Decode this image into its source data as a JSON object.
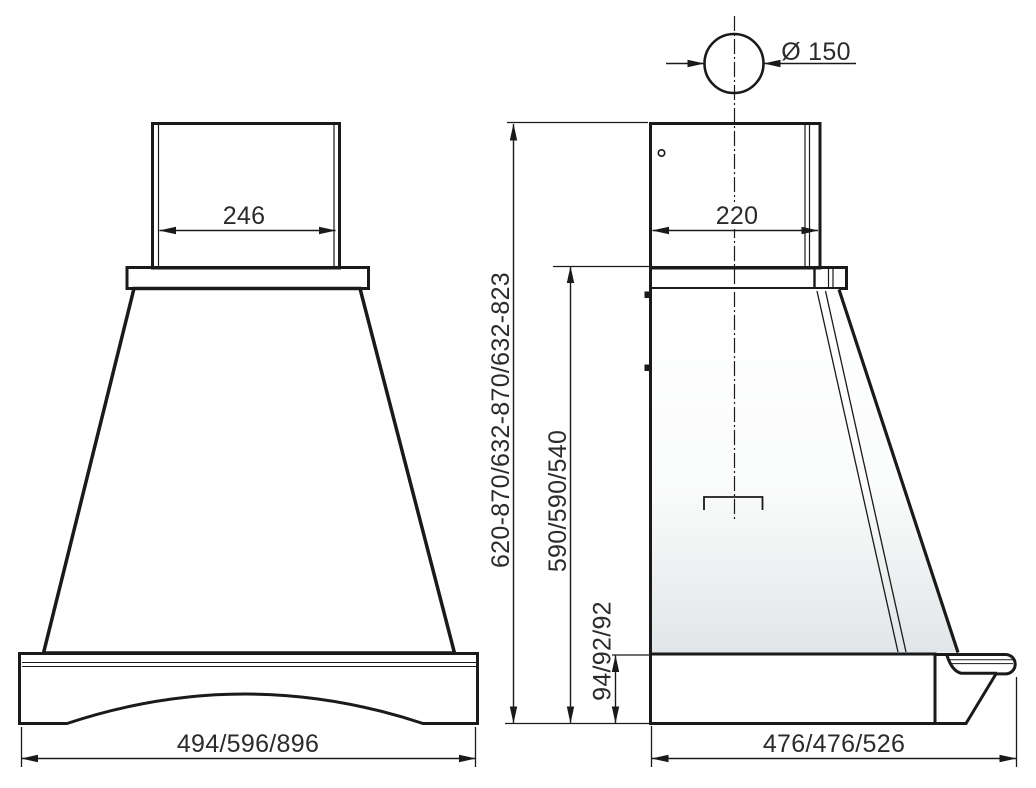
{
  "front_view": {
    "duct_width": "246",
    "overall_width": "494/596/896"
  },
  "side_view": {
    "flue_diameter": "Ø 150",
    "duct_depth": "220",
    "mounting_height_range": "620-870/632-870/632-823",
    "body_height": "590/590/540",
    "trim_height": "94/92/92",
    "overall_depth": "476/476/526"
  },
  "colors": {
    "outline": "#1a1a1a",
    "wood_trim": "#ecdab6",
    "steel_highlight": "#fbfcfc",
    "steel_shadow": "#ccd3d7",
    "body_shadow": "#e2e6e8",
    "dimension_text": "#2b2b2b"
  }
}
